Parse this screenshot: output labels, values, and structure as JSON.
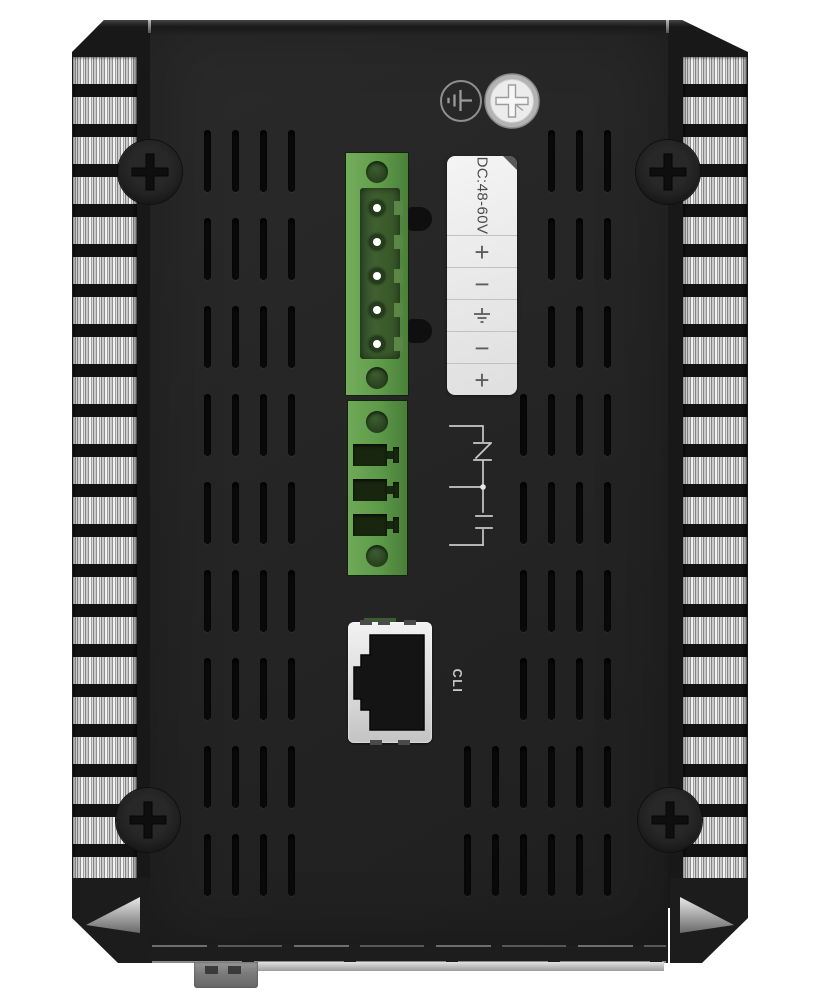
{
  "device": {
    "type": "industrial-device-rear-panel-photo",
    "power_label": {
      "title": "DC:48-60V",
      "terminals": [
        {
          "symbol": "+"
        },
        {
          "symbol": "−"
        },
        {
          "symbol": "earth-ground"
        },
        {
          "symbol": "−"
        },
        {
          "symbol": "+"
        }
      ]
    },
    "console_port": {
      "label": "CLI"
    },
    "icons": {
      "top_left_of_screw": "protective-earth-icon",
      "beside_terminal_socket": "relay-contact-schematic-icon",
      "label_row_3": "earth-ground-icon"
    },
    "colors": {
      "connector_green": "#61a04b",
      "connector_recess_green": "#3c5c2e",
      "label_background": "#ececec",
      "panel": "#242424",
      "heatsink_fin": "#d9d9d9"
    }
  }
}
